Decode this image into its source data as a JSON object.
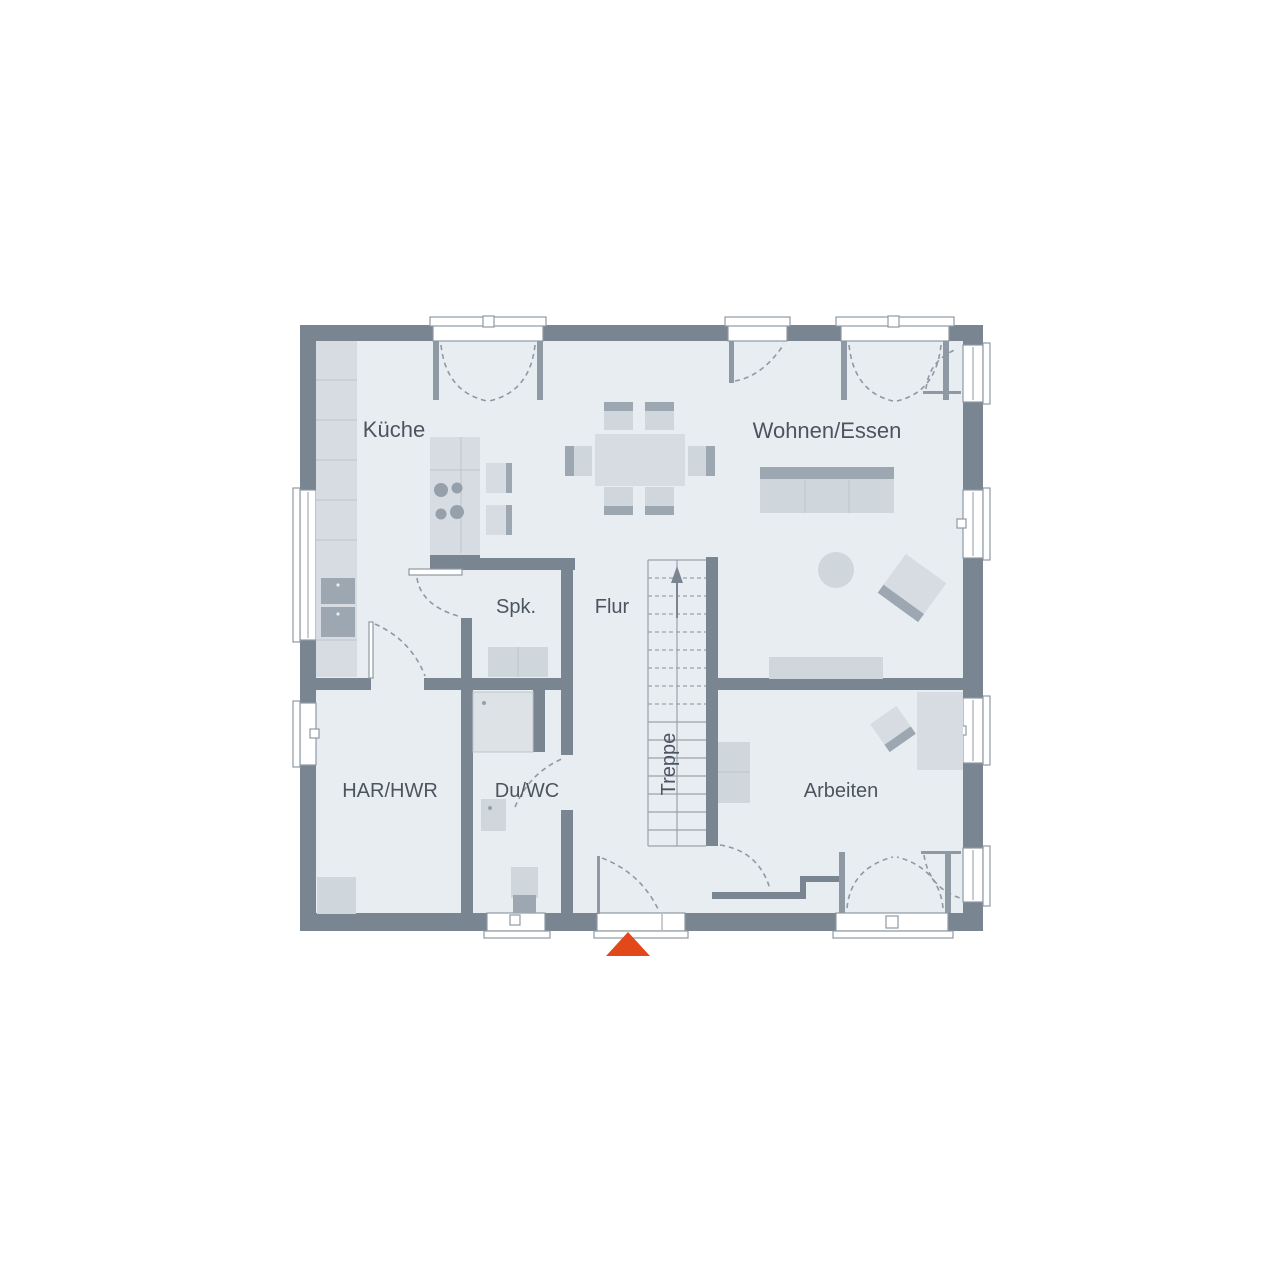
{
  "plan": {
    "type": "floor-plan",
    "floor_name": "Erdgeschoss",
    "rooms": [
      {
        "id": "kueche",
        "label": "Küche"
      },
      {
        "id": "wohnen_essen",
        "label": "Wohnen/Essen"
      },
      {
        "id": "spk",
        "label": "Spk."
      },
      {
        "id": "flur",
        "label": "Flur"
      },
      {
        "id": "treppe",
        "label": "Treppe"
      },
      {
        "id": "har_hwr",
        "label": "HAR/HWR"
      },
      {
        "id": "du_wc",
        "label": "Du/WC"
      },
      {
        "id": "arbeiten",
        "label": "Arbeiten"
      }
    ],
    "colors": {
      "wall": "#7a8592",
      "floor": "#e8edf2",
      "furniture": "#d6dce2",
      "furniture_dark": "#9ca7b2",
      "outline": "#8e99a4",
      "text": "#4b555f",
      "accent": "#e2491a",
      "background": "#ffffff"
    },
    "entrance_marker": "triangle-up"
  }
}
